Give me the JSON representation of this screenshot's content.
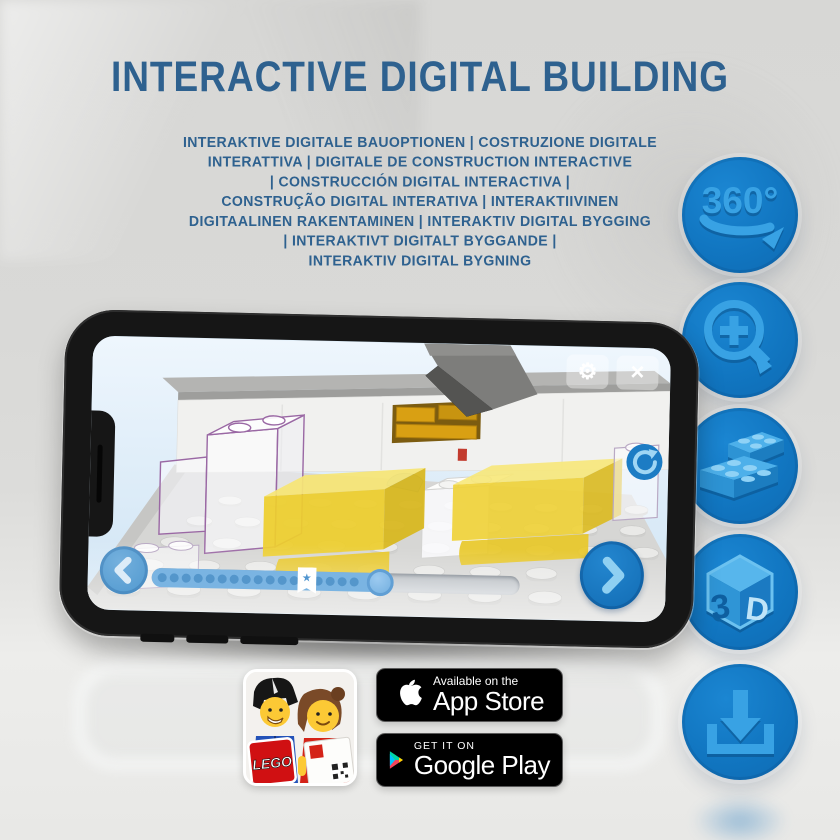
{
  "header": {
    "title": "INTERACTIVE DIGITAL BUILDING",
    "subtitle_lines": [
      "INTERAKTIVE DIGITALE BAUOPTIONEN | COSTRUZIONE DIGITALE",
      "INTERATTIVA | DIGITALE DE CONSTRUCTION INTERACTIVE",
      "| CONSTRUCCIÓN DIGITAL INTERACTIVA |",
      "CONSTRUÇÃO DIGITAL INTERATIVA | INTERAKTIIVINEN",
      "DIGITAALINEN RAKENTAMINEN | INTERAKTIV DIGITAL BYGGING",
      "| INTERAKTIVT DIGITALT BYGGANDE |",
      "INTERAKTIV DIGITAL BYGNING"
    ]
  },
  "feature_icons": [
    {
      "name": "360-rotation-icon",
      "label": "360°"
    },
    {
      "name": "zoom-in-icon"
    },
    {
      "name": "brick-icon"
    },
    {
      "name": "3d-cube-icon",
      "label_left": "3",
      "label_right": "D"
    },
    {
      "name": "download-icon"
    }
  ],
  "phone_app": {
    "gear_glyph": "⚙",
    "close_glyph": "×",
    "bookmark_star": "★",
    "progress_percent": 62,
    "bookmark_percent": 42,
    "step_dot_count": 17
  },
  "badges": {
    "lego_app_label": "LEGO",
    "app_store": {
      "line1": "Available on the",
      "line2": "App Store"
    },
    "google_play": {
      "line1": "GET IT ON",
      "line2": "Google Play"
    }
  },
  "colors": {
    "title_blue": "#2e618f",
    "circle_blue": "#1176c1",
    "icon_light_blue": "#38a2e4",
    "app_accent_blue": "#1878c2",
    "brick_yellow": "#f0d02f",
    "screen_sky": "#d9ebf8"
  }
}
